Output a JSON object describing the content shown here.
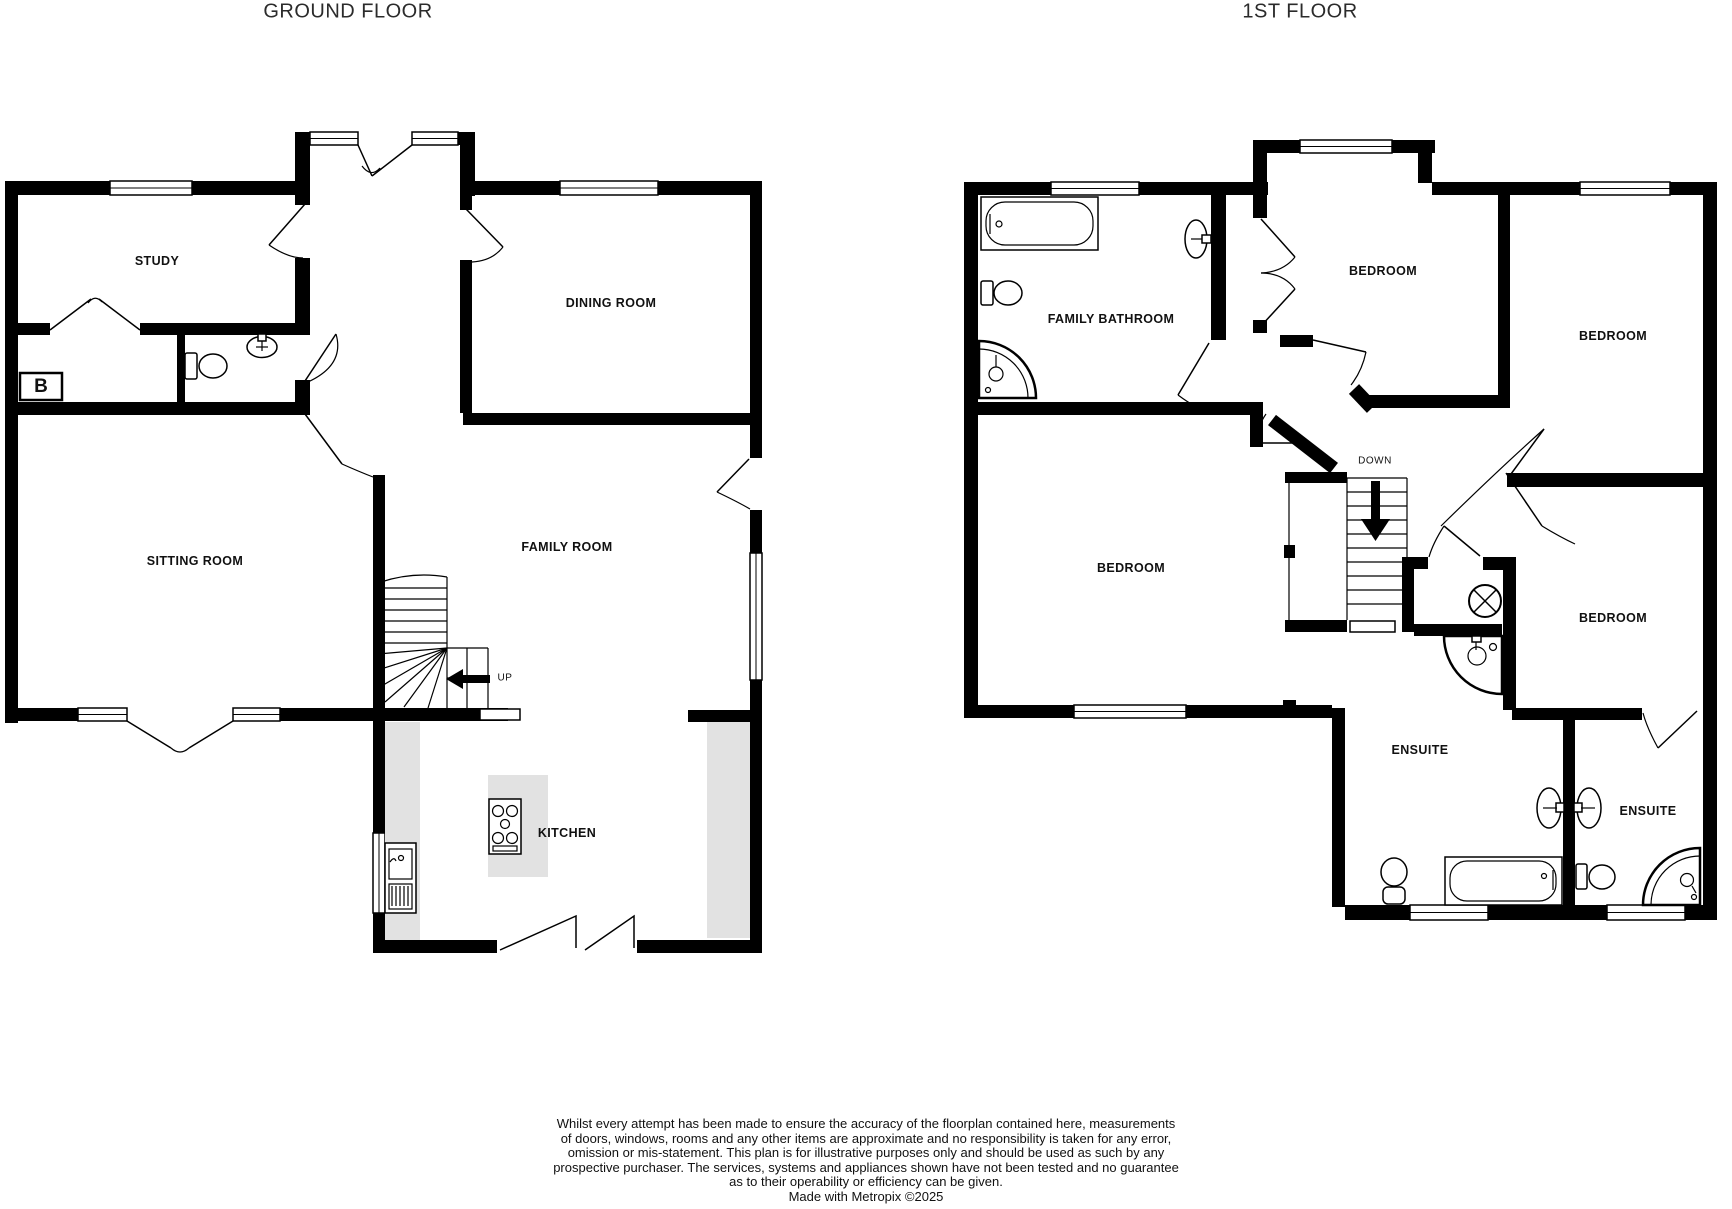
{
  "page": {
    "background": "#ffffff"
  },
  "colors": {
    "wall": "#000000",
    "counter": "#e2e2e2",
    "text": "#111111"
  },
  "ground_floor": {
    "title": "GROUND FLOOR",
    "rooms": {
      "study": "STUDY",
      "dining_room": "DINING ROOM",
      "sitting_room": "SITTING ROOM",
      "family_room": "FAMILY ROOM",
      "kitchen": "KITCHEN"
    },
    "stairs_label": "UP",
    "boiler_label": "B",
    "fixtures": [
      "toilet",
      "basin",
      "kitchen-sink",
      "hob",
      "island-counter",
      "bay-window",
      "french-doors"
    ]
  },
  "first_floor": {
    "title": "1ST FLOOR",
    "rooms": {
      "family_bathroom": "FAMILY BATHROOM",
      "bedroom_top_center": "BEDROOM",
      "bedroom_top_right": "BEDROOM",
      "bedroom_left": "BEDROOM",
      "bedroom_middle_right": "BEDROOM",
      "ensuite_1": "ENSUITE",
      "ensuite_2": "ENSUITE"
    },
    "stairs_label": "DOWN",
    "fixtures": [
      "bath",
      "pedestal-basin",
      "toilet",
      "corner-shower",
      "corner-basin",
      "cylinder",
      "bath",
      "toilet",
      "twin-basins",
      "toilet",
      "corner-shower"
    ]
  },
  "disclaimer": {
    "lines": [
      "Whilst every attempt has been made to ensure the accuracy of the floorplan contained here, measurements",
      "of doors, windows, rooms and any other items are approximate and no responsibility is taken for any error,",
      "omission or mis-statement. This plan is for illustrative purposes only and should be used as such by any",
      "prospective purchaser. The services, systems and appliances shown have not been tested and no guarantee",
      "as to their operability or efficiency can be given.",
      "Made with Metropix ©2025"
    ]
  }
}
